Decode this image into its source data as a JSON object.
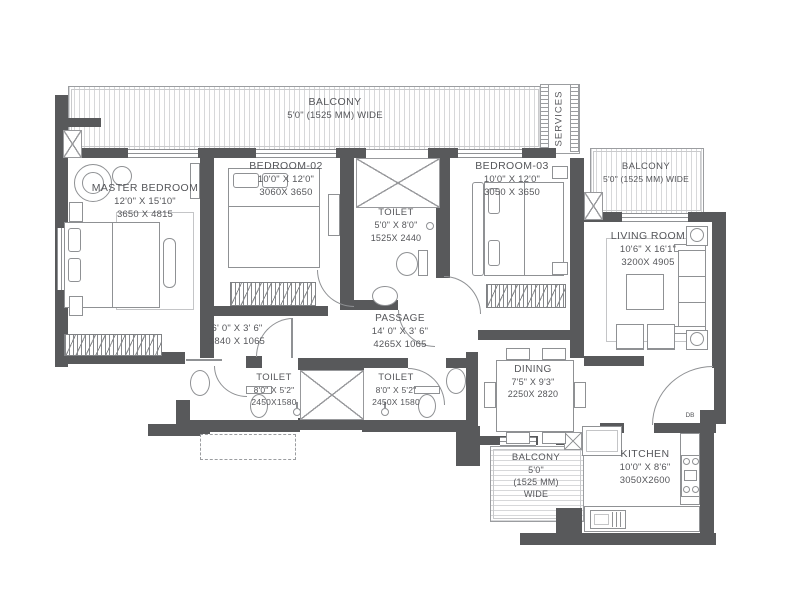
{
  "plan": {
    "balcony_top": {
      "name": "BALCONY",
      "size": "5'0\" (1525 MM) WIDE"
    },
    "services": {
      "name": "SERVICES"
    },
    "master_bedroom": {
      "name": "MASTER BEDROOM",
      "size_ft": "12'0\" X 15'10\"",
      "size_mm": "3650 X 4815"
    },
    "bedroom_02": {
      "name": "BEDROOM-02",
      "size_ft": "10'0\" X 12'0\"",
      "size_mm": "3060X 3650"
    },
    "toilet_mid": {
      "name": "TOILET",
      "size_ft": "5'0\" X 8'0\"",
      "size_mm": "1525X 2440"
    },
    "bedroom_03": {
      "name": "BEDROOM-03",
      "size_ft": "10'0\" X 12'0\"",
      "size_mm": "3050 X 3650"
    },
    "balcony_right": {
      "name": "BALCONY",
      "size": "5'0\" (1525 MM) WIDE"
    },
    "living_room": {
      "name": "LIVING ROOM",
      "size_ft": "10'6\" X 16'1\"",
      "size_mm": "3200X 4905"
    },
    "passage_small": {
      "size_ft": "6' 0\" X 3' 6\"",
      "size_mm": "1840 X 1065"
    },
    "passage": {
      "name": "PASSAGE",
      "size_ft": "14' 0\" X 3' 6\"",
      "size_mm": "4265X 1065"
    },
    "toilet_left": {
      "name": "TOILET",
      "size_ft": "8'0\" X 5'2\"",
      "size_mm": "2450X1580"
    },
    "toilet_right": {
      "name": "TOILET",
      "size_ft": "8'0\" X 5'2\"",
      "size_mm": "2450X 1580"
    },
    "dining": {
      "name": "DINING",
      "size_ft": "7'5\" X 9'3\"",
      "size_mm": "2250X 2820"
    },
    "balcony_bottom": {
      "name": "BALCONY",
      "size_l1": "5'0\"",
      "size_l2": "(1525 MM)",
      "size_l3": "WIDE"
    },
    "kitchen": {
      "name": "KITCHEN",
      "size_ft": "10'0\" X 8'6\"",
      "size_mm": "3050X2600"
    },
    "db_label": "DB"
  },
  "colors": {
    "wall": "#58595b",
    "line": "#8f9194",
    "stripe": "#d7d8da",
    "text": "#55565a"
  }
}
